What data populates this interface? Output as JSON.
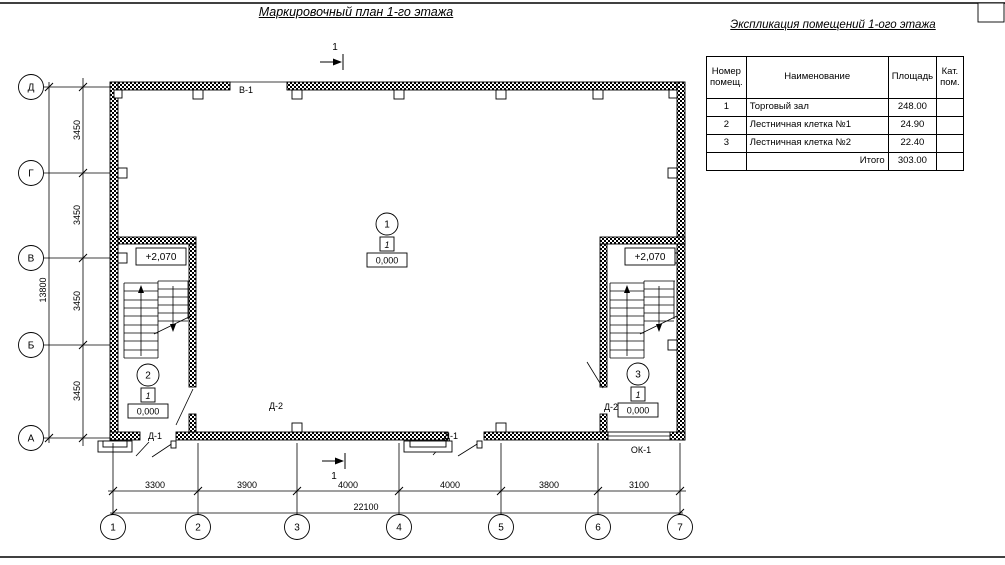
{
  "titles": {
    "plan": "Маркировочный план 1-го этажа",
    "explication": "Экспликация помещений 1-ого этажа"
  },
  "explication_table": {
    "headers": {
      "num": "Номер\nпомещ.",
      "name": "Наименование",
      "area": "Площадь",
      "cat": "Кат.\nпом."
    },
    "rows": [
      {
        "num": "1",
        "name": "Торговый зал",
        "area": "248.00",
        "cat": ""
      },
      {
        "num": "2",
        "name": "Лестничная клетка №1",
        "area": "24.90",
        "cat": ""
      },
      {
        "num": "3",
        "name": "Лестничная клетка №2",
        "area": "22.40",
        "cat": ""
      },
      {
        "num": "",
        "name": "Итого",
        "area": "303.00",
        "cat": ""
      }
    ]
  },
  "axes": {
    "rows": [
      "Д",
      "Г",
      "В",
      "Б",
      "А"
    ],
    "cols": [
      "1",
      "2",
      "3",
      "4",
      "5",
      "6",
      "7"
    ]
  },
  "dims": {
    "left": [
      "3450",
      "3450",
      "3450",
      "3450"
    ],
    "left_total": "13800",
    "bottom": [
      "3300",
      "3900",
      "4000",
      "4000",
      "3800",
      "3100"
    ],
    "bottom_total": "22100"
  },
  "levels": {
    "ground": "0,000",
    "upper": "+2,070"
  },
  "rooms": [
    {
      "num": "1",
      "type": "1"
    },
    {
      "num": "2",
      "type": "1"
    },
    {
      "num": "3",
      "type": "1"
    }
  ],
  "openings": {
    "gate": "В-1",
    "door_exterior": "Д-1",
    "door_interior": "Д-2",
    "window": "ОК-1"
  },
  "section": {
    "label": "1"
  },
  "colors": {
    "ink": "#000000",
    "paper": "#ffffff"
  }
}
